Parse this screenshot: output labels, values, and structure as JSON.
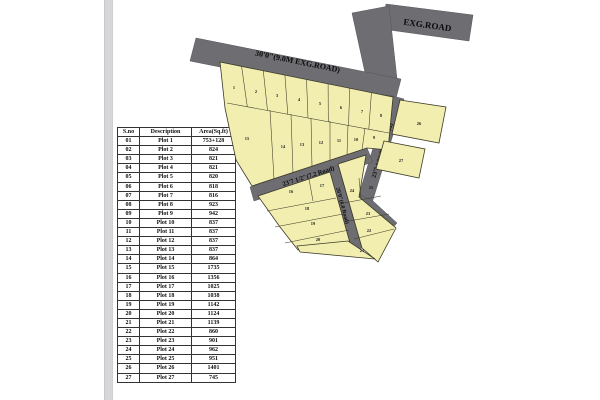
{
  "page": {
    "background": "#ffffff",
    "divider_color": "#d7d7da"
  },
  "table": {
    "headers": [
      "S.no",
      "Description",
      "Area(Sq.ft)"
    ],
    "rows": [
      [
        "01",
        "Plot 1",
        "753+128"
      ],
      [
        "02",
        "Plot 2",
        "824"
      ],
      [
        "03",
        "Plot 3",
        "821"
      ],
      [
        "04",
        "Plot 4",
        "821"
      ],
      [
        "05",
        "Plot 5",
        "820"
      ],
      [
        "06",
        "Plot 6",
        "818"
      ],
      [
        "07",
        "Plot 7",
        "816"
      ],
      [
        "08",
        "Plot 8",
        "923"
      ],
      [
        "09",
        "Plot 9",
        "942"
      ],
      [
        "10",
        "Plot 10",
        "837"
      ],
      [
        "11",
        "Plot 11",
        "837"
      ],
      [
        "12",
        "Plot 12",
        "837"
      ],
      [
        "13",
        "Plot 13",
        "837"
      ],
      [
        "14",
        "Plot 14",
        "864"
      ],
      [
        "15",
        "Plot 15",
        "1735"
      ],
      [
        "16",
        "Plot 16",
        "1356"
      ],
      [
        "17",
        "Plot 17",
        "1025"
      ],
      [
        "18",
        "Plot 18",
        "1038"
      ],
      [
        "19",
        "Plot 19",
        "1142"
      ],
      [
        "20",
        "Plot 20",
        "1124"
      ],
      [
        "21",
        "Plot 21",
        "1139"
      ],
      [
        "22",
        "Plot 22",
        "860"
      ],
      [
        "23",
        "Plot 23",
        "901"
      ],
      [
        "24",
        "Plot 24",
        "962"
      ],
      [
        "25",
        "Plot 25",
        "951"
      ],
      [
        "26",
        "Plot 26",
        "1401"
      ],
      [
        "27",
        "Plot 27",
        "745"
      ]
    ]
  },
  "map": {
    "colors": {
      "road": "#6d6d72",
      "plot_fill": "#f1eeb0",
      "outline": "#3c3a28"
    },
    "road_labels": {
      "exg_top": "EXG.ROAD",
      "exg_main": "30'0\"(9.0M EXG.ROAD)",
      "r72_right": "23'7 1/2\"(7.2 M Road)",
      "r72_mid": "23'7 1/2\"(7.2 Road)",
      "r60": "20'0\"(6.0 Road)"
    },
    "plot_numbers": [
      "1",
      "2",
      "3",
      "4",
      "5",
      "6",
      "7",
      "8",
      "9",
      "10",
      "11",
      "12",
      "13",
      "14",
      "15",
      "16",
      "17",
      "18",
      "19",
      "20",
      "21",
      "22",
      "23",
      "24",
      "25",
      "26",
      "27"
    ]
  }
}
